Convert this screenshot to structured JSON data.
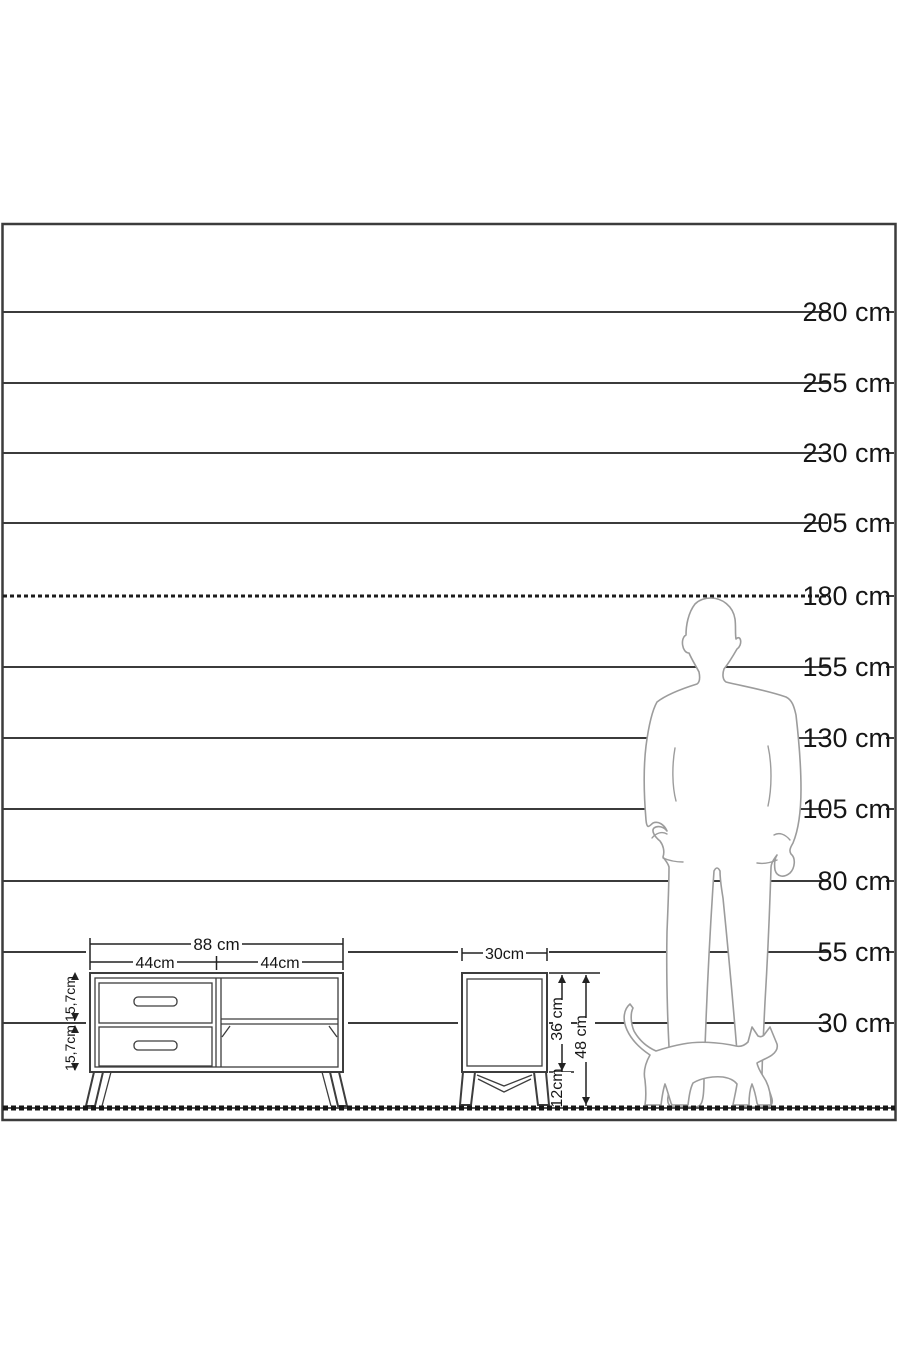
{
  "scale": {
    "unit": "cm",
    "labels": [
      "280 cm",
      "255 cm",
      "230 cm",
      "205 cm",
      "180 cm",
      "155 cm",
      "130 cm",
      "105 cm",
      "80 cm",
      "55 cm",
      "30 cm"
    ]
  },
  "tv_stand": {
    "width_label": "88 cm",
    "left_section_label": "44cm",
    "right_section_label": "44cm",
    "top_drawer_height_label": "15,7cm",
    "bottom_drawer_height_label": "15,7cm"
  },
  "nightstand": {
    "width_label": "30cm",
    "body_height_label": "36 cm",
    "leg_height_label": "12cm",
    "total_height_label": "48 cm"
  },
  "colors": {
    "chart_line": "#3b3b3b",
    "reference_line": "#1c1c1c",
    "silhouette_outline": "#9c9c9c",
    "label_text": "#161616"
  }
}
